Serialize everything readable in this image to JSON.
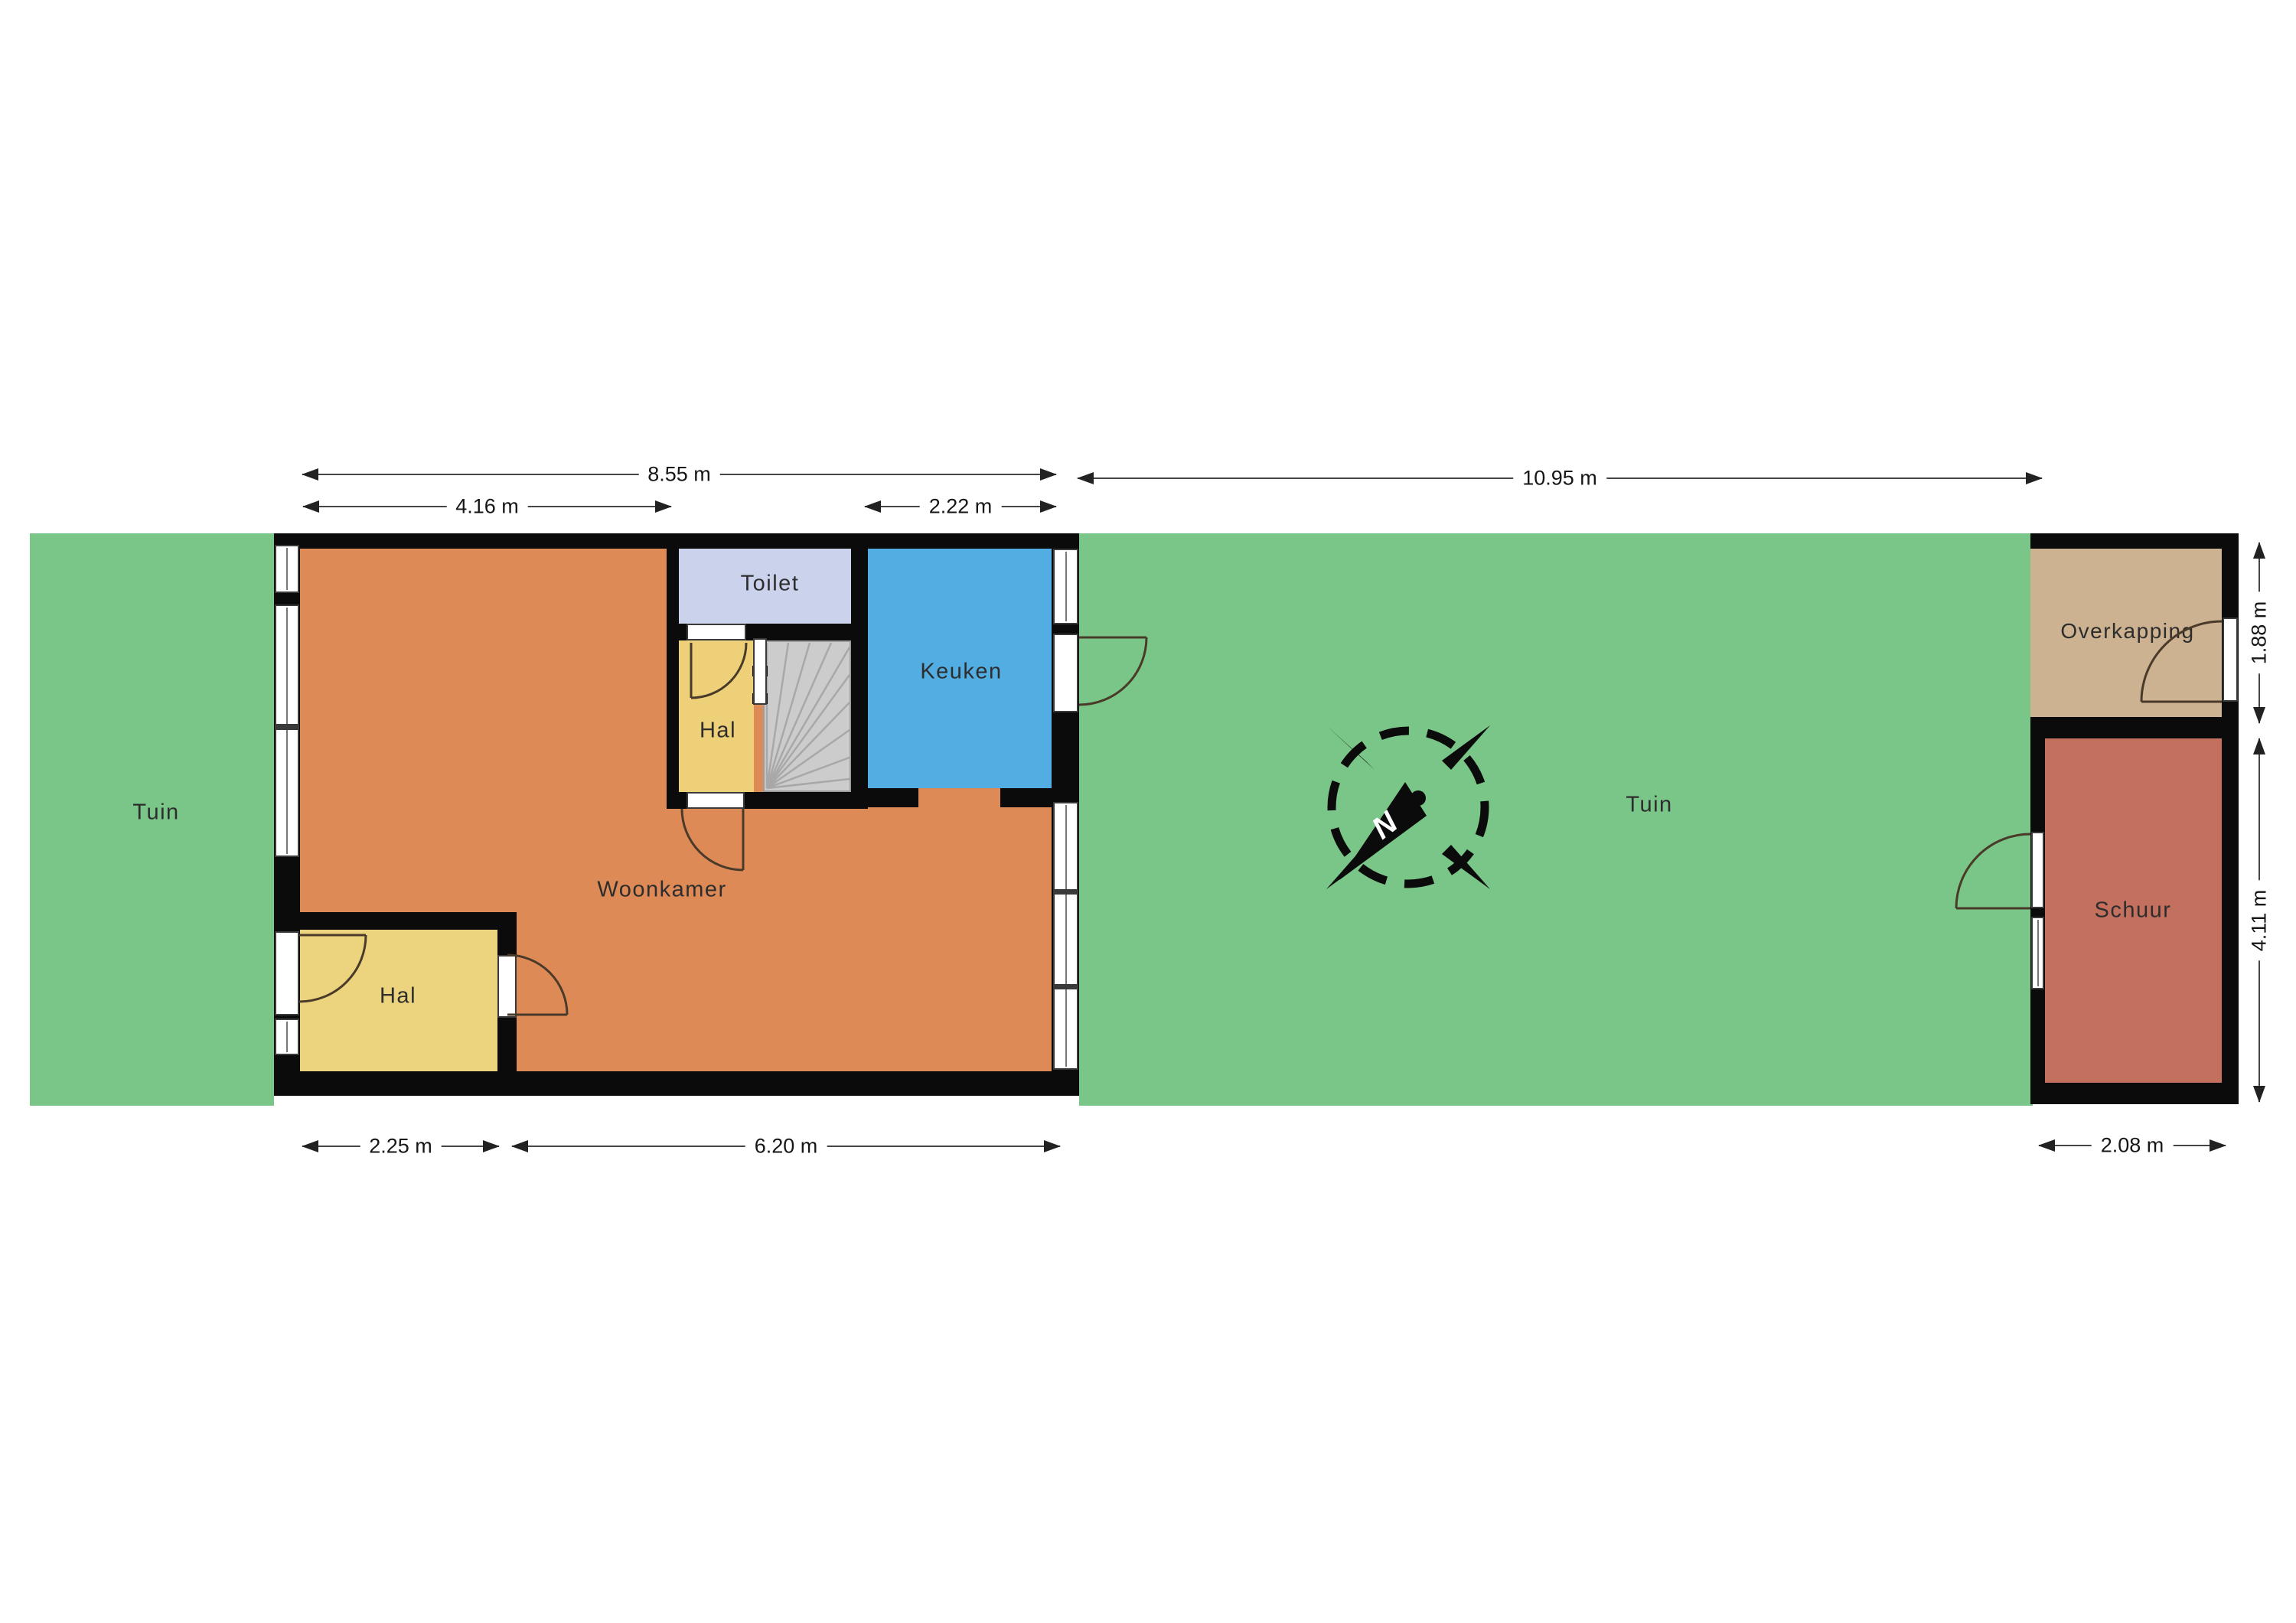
{
  "fp": {
    "rooms": {
      "woonkamer": "Woonkamer",
      "keuken": "Keuken",
      "toilet": "Toilet",
      "hal_upper": "Hal",
      "hal_lower": "Hal",
      "overkapping": "Overkapping",
      "schuur": "Schuur"
    },
    "garden": {
      "left": "Tuin",
      "right": "Tuin"
    },
    "dims": {
      "house_width": "8.55 m",
      "left_section_width": "4.16 m",
      "kitchen_width": "2.22 m",
      "garden_width": "10.95 m",
      "hall_width": "2.25 m",
      "living_width": "6.20 m",
      "shed_width": "2.08 m",
      "carport_depth": "1.88 m",
      "shed_depth": "4.11 m"
    },
    "compass": {
      "north": "N"
    },
    "colors": {
      "garden": "#7ac588",
      "living": "#dd8a57",
      "hall": "#edd077",
      "kitchen": "#52ade2",
      "toilet": "#cbd2ec",
      "stairs": "#cccccc",
      "carport": "#ccb290",
      "shed": "#c4705f",
      "wall": "#0b0b0b"
    }
  }
}
